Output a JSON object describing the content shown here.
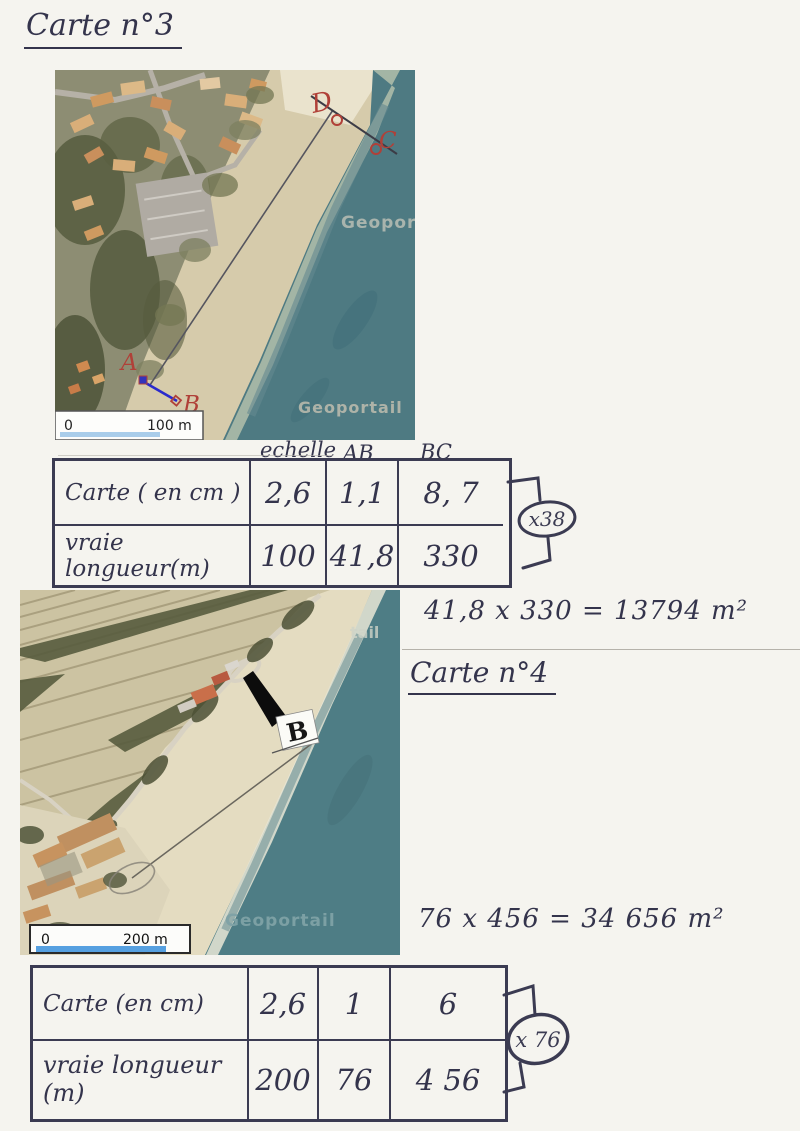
{
  "titles": {
    "carte3": "Carte n°3",
    "carte4": "Carte n°4"
  },
  "calcs": {
    "area1": "41,8 x 330 = 13794 m²",
    "area2": "76 x 456 = 34 656 m²"
  },
  "table1": {
    "headers": {
      "echelle": "echelle",
      "ab": "AB",
      "bc": "BC"
    },
    "row1": {
      "label": "Carte ( en cm )",
      "v1": "2,6",
      "v2": "1,1",
      "v3": "8, 7"
    },
    "row2": {
      "label": "vraie longueur(m)",
      "v1": "100",
      "v2": "41,8",
      "v3": "330"
    },
    "multiplier": "x38"
  },
  "table2": {
    "row1": {
      "label": "Carte (en cm)",
      "v1": "2,6",
      "v2": "1",
      "v3": "6"
    },
    "row2": {
      "label": "vraie longueur (m)",
      "v1": "200",
      "v2": "76",
      "v3": "4 56"
    },
    "multiplier": "x 76"
  },
  "photo1": {
    "points": {
      "a": "A",
      "b": "B",
      "c": "C",
      "d": "D"
    },
    "scalebar": {
      "start": "0",
      "end": "100 m"
    },
    "watermarks": {
      "mid": "Geopor",
      "bottom": "Geoportail"
    }
  },
  "photo2": {
    "point_b": "B",
    "scalebar": {
      "start": "0",
      "end": "200 m"
    },
    "watermarks": {
      "sea": "Geoportail",
      "top": "tail"
    }
  },
  "colors": {
    "ink": "#3b3b52",
    "annotation_red": "#b04038",
    "annotation_blue": "#2a2acc",
    "sea": "#4e7a82",
    "scalebar_blue_photo1": "#a9cdea",
    "scalebar_blue_photo2": "#56a0e0"
  }
}
